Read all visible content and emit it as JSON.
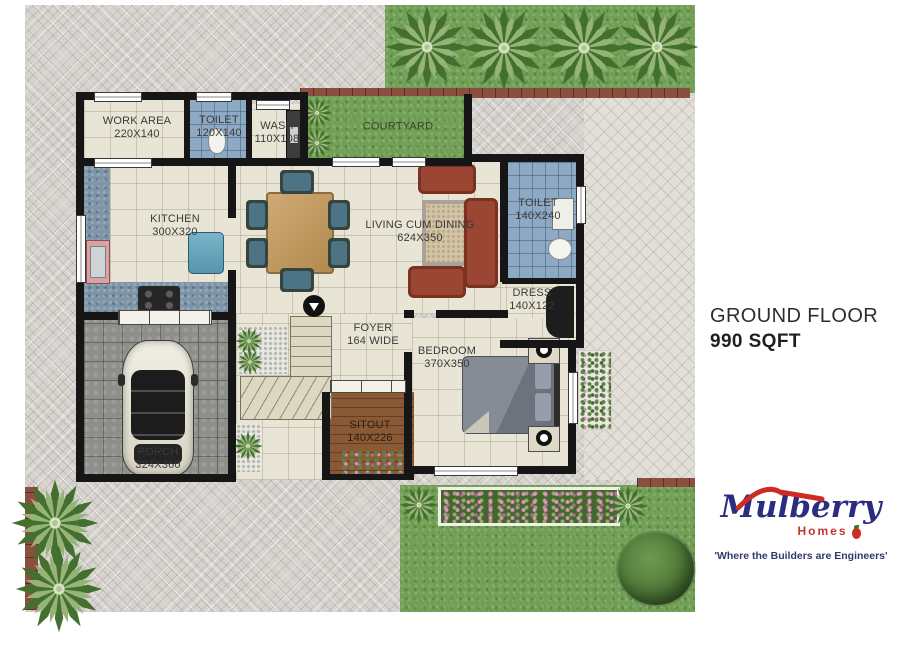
{
  "header": {
    "title": "GROUND FLOOR",
    "area": "990 SQFT"
  },
  "rooms": {
    "work_area": {
      "name": "WORK AREA",
      "dims": "220X140"
    },
    "toilet_1": {
      "name": "TOILET",
      "dims": "120X140"
    },
    "wash": {
      "name": "WASH",
      "dims": "110X108"
    },
    "courtyard": {
      "name": "COURTYARD"
    },
    "kitchen": {
      "name": "KITCHEN",
      "dims": "300X320"
    },
    "living_dining": {
      "name": "LIVING CUM DINING",
      "dims": "624X350"
    },
    "toilet_2": {
      "name": "TOILET",
      "dims": "140X240"
    },
    "dress": {
      "name": "DRESS",
      "dims": "140X122"
    },
    "foyer": {
      "name": "FOYER",
      "dims": "164 WIDE"
    },
    "bedroom": {
      "name": "BEDROOM",
      "dims": "370X350"
    },
    "sitout": {
      "name": "SITOUT",
      "dims": "140X226"
    },
    "porch": {
      "name": "PORCH",
      "dims": "324X360"
    }
  },
  "logo": {
    "brand": "Mulberry",
    "sub": "Homes",
    "tagline": "'Where the Builders are Engineers'"
  },
  "colors": {
    "wall": "#161616",
    "floor": "#e9e5d6",
    "tile_blue": "#8ea9c3",
    "lawn_green": "#6f9e53",
    "sofa_terracotta": "#9a4632",
    "brand_navy": "#2b2e80",
    "brand_red": "#c2372b"
  }
}
